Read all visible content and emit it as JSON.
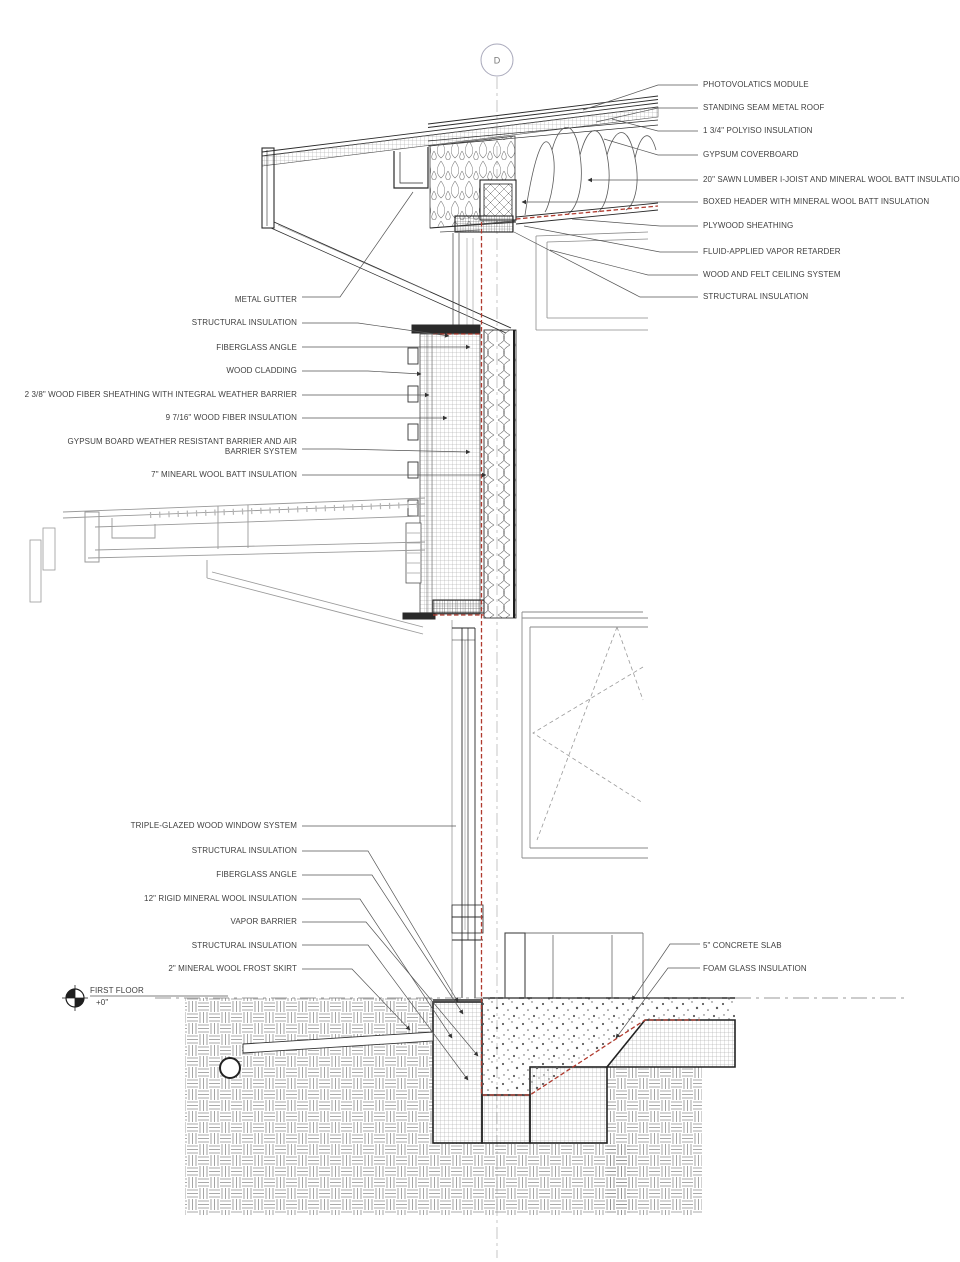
{
  "drawing_title": "Wall section detail at grid D",
  "grid_bubble": "D",
  "level_marker": {
    "label": "FIRST FLOOR",
    "elevation": "+0\""
  },
  "callouts": {
    "roof_right": [
      "PHOTOVOLATICS MODULE",
      "STANDING SEAM METAL ROOF",
      "1 3/4\" POLYISO INSULATION",
      "GYPSUM COVERBOARD",
      "20\" SAWN LUMBER I-JOIST  AND MINERAL WOOL BATT INSULATION",
      "BOXED HEADER WITH MINERAL WOOL BATT INSULATION",
      "PLYWOOD SHEATHING",
      "FLUID-APPLIED VAPOR RETARDER",
      "WOOD AND FELT CEILING SYSTEM",
      "STRUCTURAL INSULATION"
    ],
    "wall_left": [
      "METAL GUTTER",
      "STRUCTURAL INSULATION",
      "FIBERGLASS ANGLE",
      "WOOD CLADDING",
      "2 3/8\" WOOD FIBER SHEATHING WITH INTEGRAL WEATHER BARRIER",
      "9 7/16\" WOOD FIBER INSULATION",
      "GYPSUM BOARD WEATHER RESISTANT BARRIER AND AIR BARRIER SYSTEM",
      "7\" MINEARL WOOL BATT INSULATION"
    ],
    "base_left": [
      "TRIPLE-GLAZED WOOD WINDOW SYSTEM",
      "STRUCTURAL INSULATION",
      "FIBERGLASS ANGLE",
      "12\" RIGID MINERAL WOOL INSULATION",
      "VAPOR BARRIER",
      "STRUCTURAL INSULATION",
      "2\" MINERAL WOOL FROST SKIRT"
    ],
    "slab_right": [
      "5\" CONCRETE SLAB",
      "FOAM GLASS INSULATION"
    ]
  },
  "colors": {
    "vapor_barrier_red": "#b03a2e",
    "drawing_line": "#2a2a2a",
    "light_line": "#9a9a9a",
    "leader_line": "#555555",
    "background": "#ffffff"
  }
}
